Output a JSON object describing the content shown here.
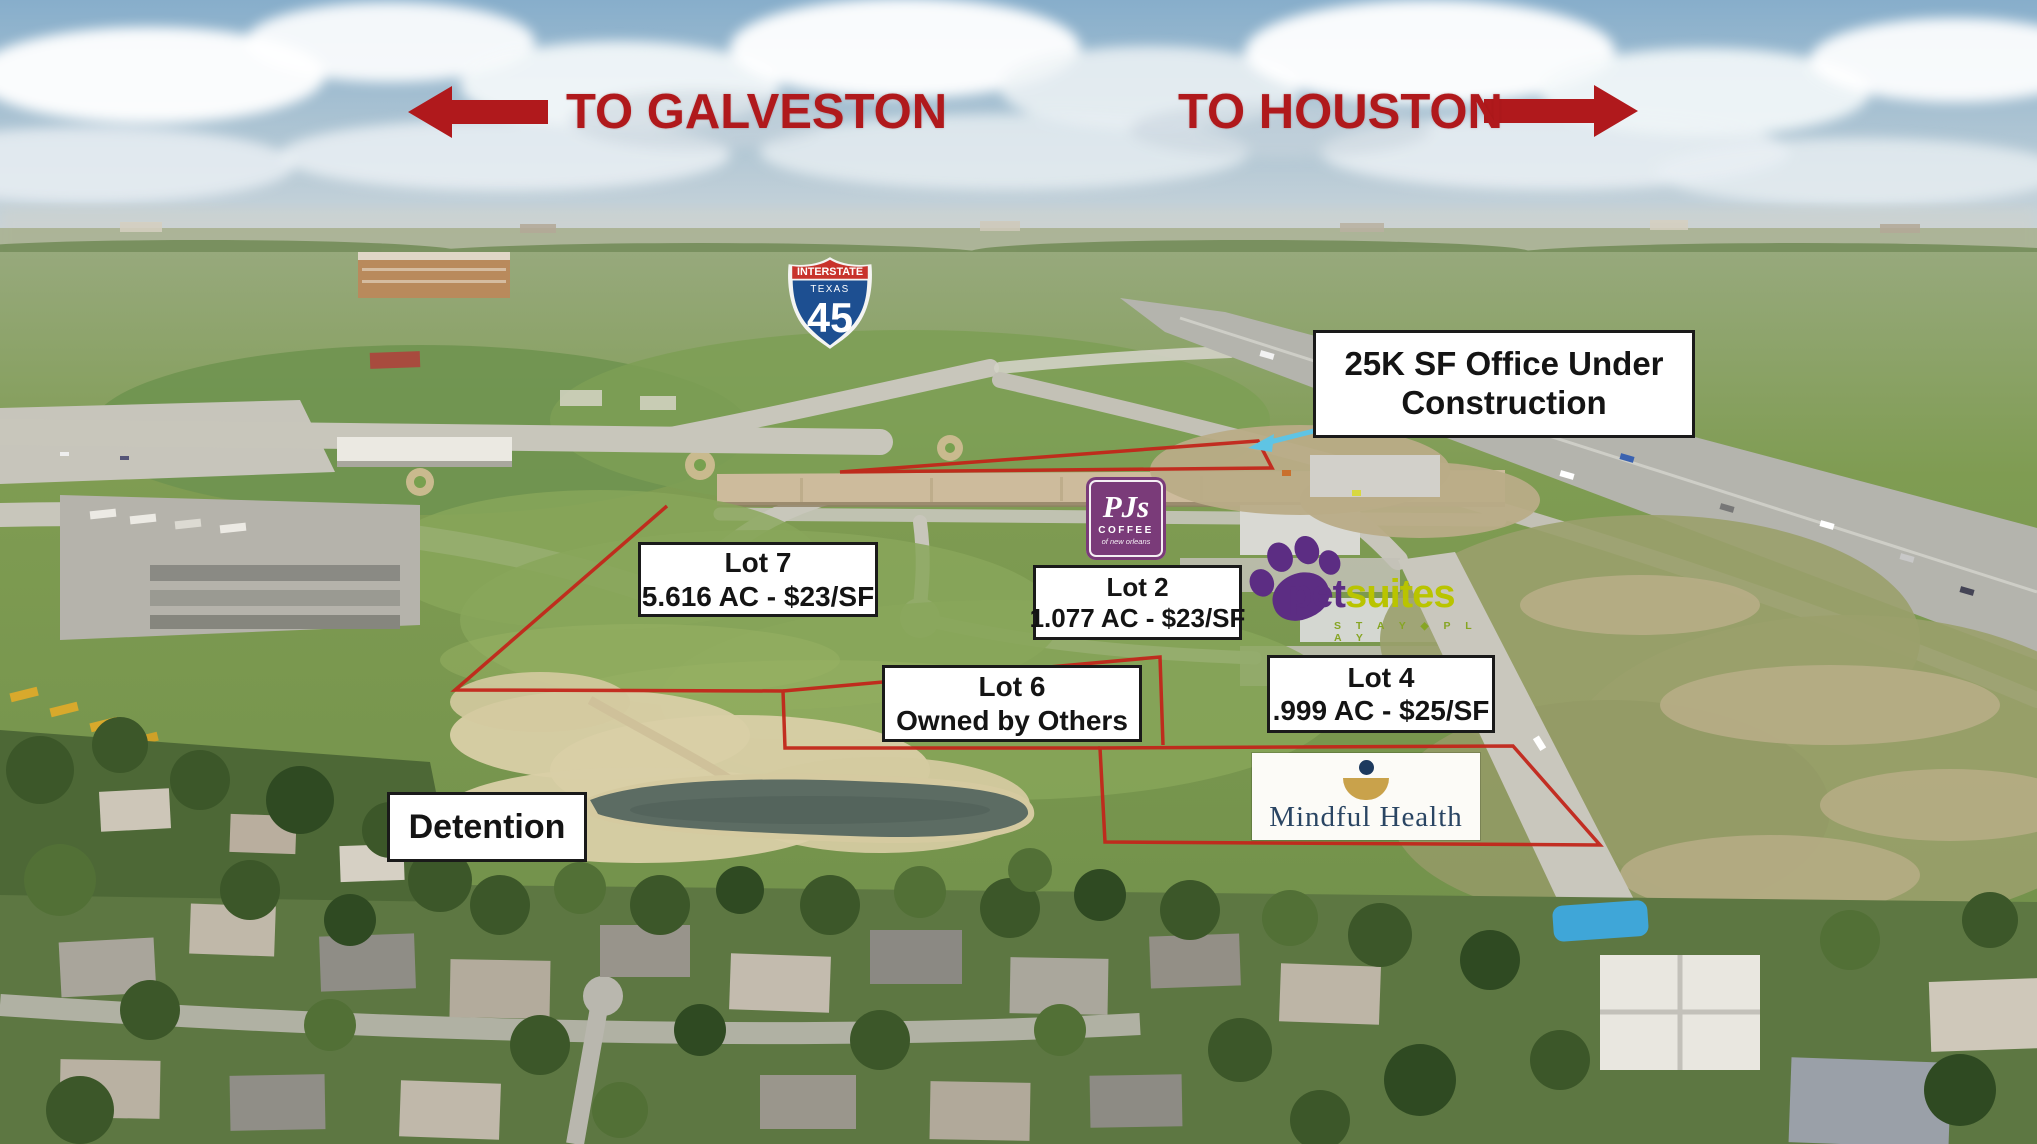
{
  "directions": {
    "west_label": "TO GALVESTON",
    "east_label": "TO HOUSTON"
  },
  "highway_shield": {
    "header": "INTERSTATE",
    "state": "TEXAS",
    "number": "45"
  },
  "callouts": {
    "office_construction": {
      "line1": "25K SF Office Under",
      "line2": "Construction"
    },
    "lot7": {
      "title": "Lot 7",
      "detail": "5.616 AC - $23/SF"
    },
    "lot2": {
      "title": "Lot 2",
      "detail": "1.077 AC - $23/SF"
    },
    "lot6": {
      "title": "Lot 6",
      "detail": "Owned by Others"
    },
    "lot4": {
      "title": "Lot 4",
      "detail": ".999 AC - $25/SF"
    },
    "detention": {
      "title": "Detention"
    }
  },
  "tenant_logos": {
    "pjs_coffee": {
      "name": "PJs",
      "line2": "COFFEE",
      "line3": "of new orleans"
    },
    "petsuites": {
      "word1": "pet",
      "word2": "suites",
      "tagline": "S T A Y ◆ P L A Y"
    },
    "mindful_health": {
      "name": "Mindful Health"
    }
  },
  "colors": {
    "annotation_red": "#b0191c",
    "parcel_outline_red": "#c2261a",
    "callout_arrow_blue": "#5fc4e4",
    "pjs_purple": "#7a3b79",
    "petsuites_purple": "#5c2d83",
    "petsuites_green": "#b9c400",
    "mindful_navy": "#2a4563",
    "mindful_gold": "#c9a24b",
    "interstate_blue": "#1d4f91",
    "interstate_red": "#c8332c"
  }
}
